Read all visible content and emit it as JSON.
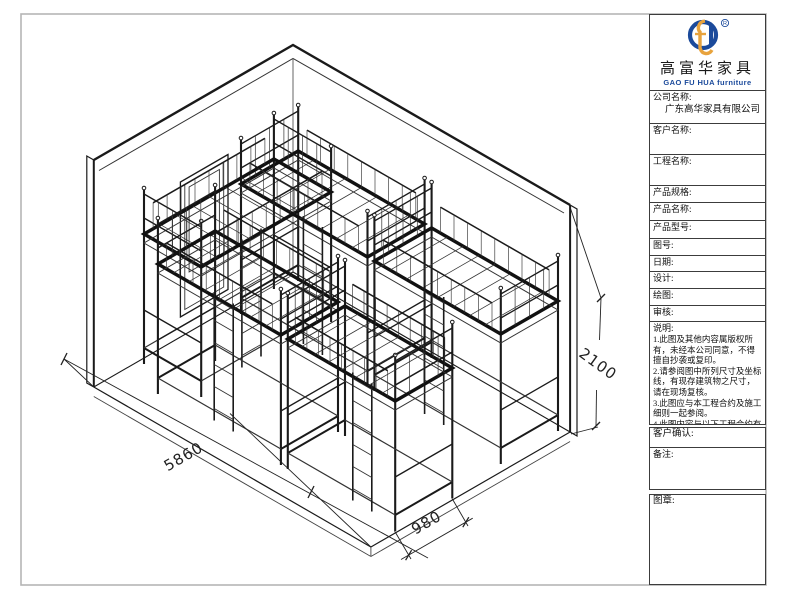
{
  "sheet": {
    "border_color": "#b5b5b5",
    "line_color": "#1a1a1a",
    "background": "#ffffff"
  },
  "drawing": {
    "type": "isometric dormitory loft-bed layout drawing",
    "dimensions": {
      "floor_length": "5860",
      "bed_width": "980",
      "wall_height": "2100"
    }
  },
  "title_block": {
    "logo": {
      "registered_mark": "®",
      "blue": "#1b4a9b",
      "gold": "#e8a33d"
    },
    "brand_cn": "高富华家具",
    "brand_en": "GAO FU HUA furniture",
    "fields": {
      "company_label": "公司名称:",
      "company_value": "广东高华家具有限公司",
      "customer_label": "客户名称:",
      "project_label": "工程名称:",
      "spec_label": "产品规格:",
      "product_name_label": "产品名称:",
      "model_label": "产品型号:",
      "figure_no_label": "图号:",
      "date_label": "日期:",
      "design_label": "设计:",
      "draft_label": "绘图:",
      "review_label": "审核:"
    },
    "notes": {
      "label": "说明:",
      "items": [
        "1.此图及其他内容属版权所有，未经本公司同意，不得擅自抄袭或复印。",
        "2.请参阅图中所列尺寸及坐标线，有现存建筑物之尺寸，请在现场复核。",
        "3.此图应与本工程合约及施工细则一起参阅。",
        "4.此图内容与以下工程合约有关。"
      ]
    },
    "confirm_label": "客户确认:",
    "remarks_label": "备注:",
    "seal_label": "图章:"
  }
}
